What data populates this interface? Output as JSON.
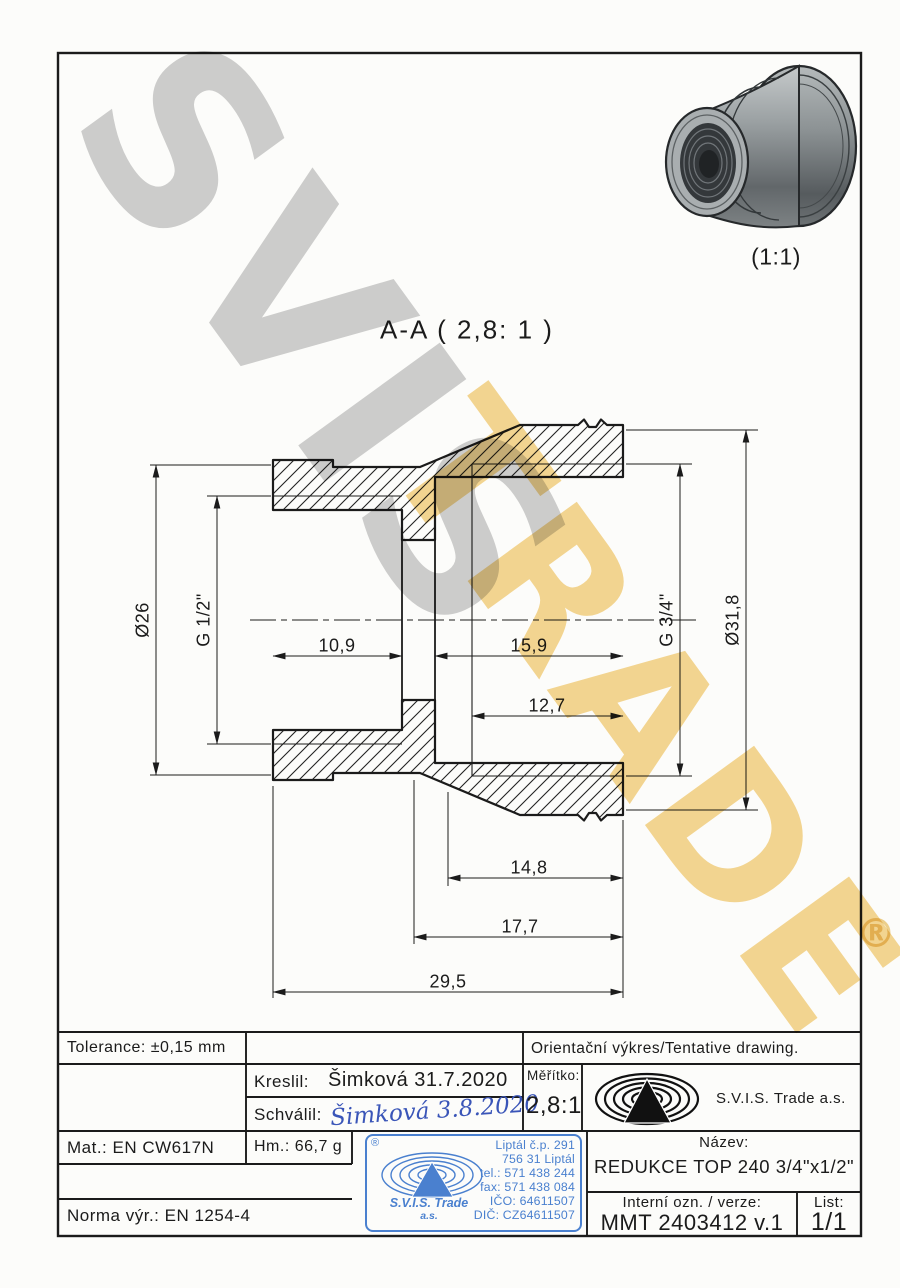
{
  "watermarks": {
    "gray_text": "SVIS",
    "yellow_text": "TRADE",
    "registered": "®",
    "gray_color": "#cfcfcf",
    "yellow_color": "#f5d48a"
  },
  "pictorial": {
    "scale": "(1:1)"
  },
  "section_view": {
    "title": "A-A ( 2,8: 1 )",
    "dims": {
      "od_left": "Ø26",
      "thread_left": "G 1/2\"",
      "depth_left": "10,9",
      "depth_right": "15,9",
      "thread_len_right": "12,7",
      "relief_len": "14,8",
      "body_len": "17,7",
      "total_len": "29,5",
      "thread_right": "G 3/4\"",
      "od_right": "Ø31,8"
    }
  },
  "title_block": {
    "tolerance": "Tolerance: ±0,15 mm",
    "note": "Orientační výkres/Tentative drawing.",
    "kreslil_label": "Kreslil:",
    "kreslil_value": "Šimková 31.7.2020",
    "schvalil_label": "Schválil:",
    "schvalil_value": "Šimková 3.8.2020",
    "meritko_label": "Měřítko:",
    "meritko_value": "2,8:1",
    "company": "S.V.I.S. Trade a.s.",
    "mat": "Mat.: EN CW617N",
    "hm": "Hm.: 66,7 g",
    "norma": "Norma výr.: EN 1254-4",
    "nazev_label": "Název:",
    "nazev_value": "REDUKCE TOP 240 3/4\"x1/2\"",
    "interni_label": "Interní ozn. / verze:",
    "interni_value": "MMT 2403412 v.1",
    "list_label": "List:",
    "list_value": "1/1"
  },
  "stamp": {
    "registered": "®",
    "company": "S.V.I.S. Trade",
    "suffix": "a.s.",
    "address": [
      "Liptál č.p. 291",
      "756 31 Liptál",
      "tel.: 571 438 244",
      "fax: 571 438 084",
      "IČO: 64611507",
      "DIČ: CZ64611507"
    ],
    "blue": "#4a80cf"
  }
}
